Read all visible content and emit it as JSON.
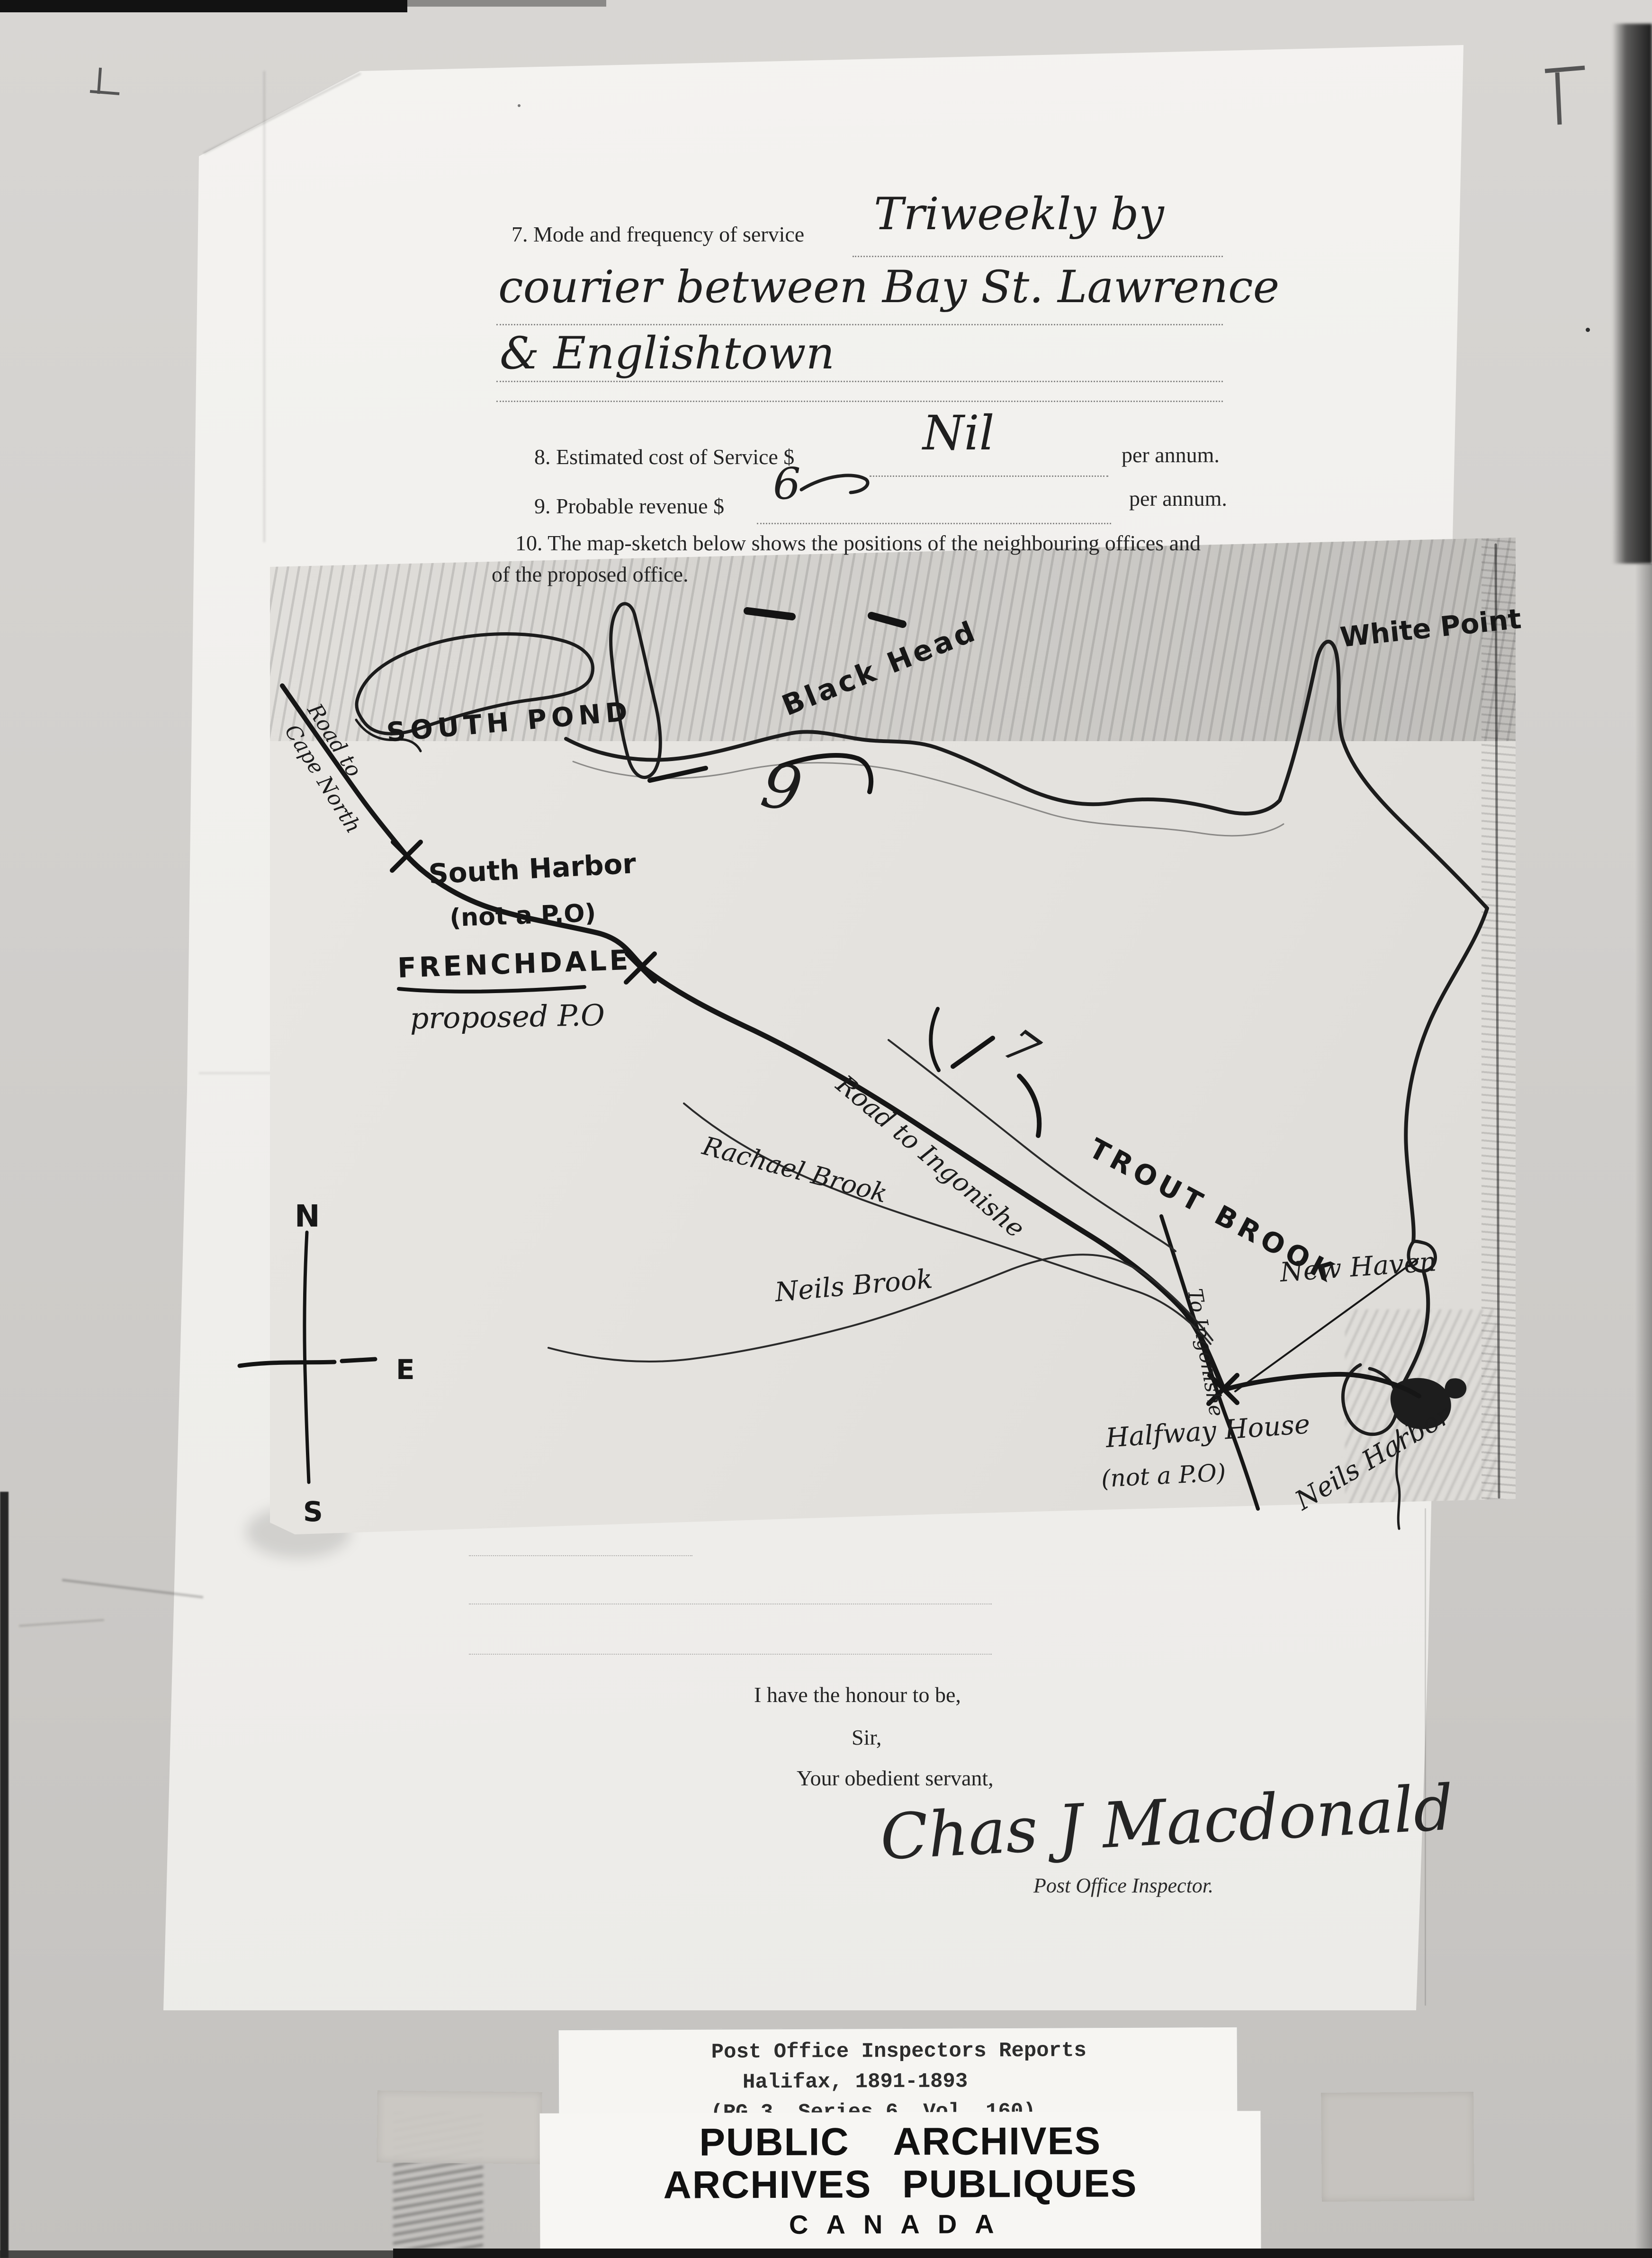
{
  "form": {
    "q7_label": "7. Mode and frequency of service",
    "q7_answer1": "Triweekly by",
    "q7_answer2": "courier between Bay St. Lawrence",
    "q7_answer3": "& Englishtown",
    "q8_label": "8. Estimated cost of Service $",
    "q8_answer": "Nil",
    "q8_per": "per annum.",
    "q9_label": "9. Probable revenue $",
    "q9_answer": "6",
    "q9_per": "per annum.",
    "q10_line1": "10. The map-sketch below shows the positions of the neighbouring offices and",
    "q10_line2": "of the proposed office."
  },
  "map": {
    "labels": {
      "south_pond": "South Pond",
      "black_head": "Black Head",
      "white_point": "White Point",
      "road_cape_north_1": "Road to",
      "road_cape_north_2": "Cape North",
      "south_harbor_1": "South Harbor",
      "south_harbor_2": "(not a P.O)",
      "frenchdale_1": "FRENCHDALE",
      "frenchdale_2": "proposed P.O",
      "road_ingonishe": "Road to Ingonishe",
      "trout_brook": "Trout Brook",
      "rachael_brook": "Rachael Brook",
      "neils_brook": "Neils Brook",
      "to_ingonishe": "To Ingonishe",
      "new_haven": "New Haven",
      "halfway_house_1": "Halfway House",
      "halfway_house_2": "(not a P.O)",
      "neils_harbor": "Neils Harbor"
    },
    "markers": {
      "mile_9": "9",
      "mile_7": "7"
    },
    "compass": {
      "north": "N",
      "east": "E",
      "south": "S"
    }
  },
  "closing": {
    "line1": "I have the honour to be,",
    "line2": "Sir,",
    "line3": "Your obedient servant,",
    "signature": "Chas J Macdonald",
    "title": "Post Office Inspector."
  },
  "archive_label": {
    "line1": "Post Office Inspectors Reports",
    "line2": "Halifax, 1891-1893",
    "line3": "(RG 3, Series 6, Vol. 160)"
  },
  "footer": {
    "line1": "PUBLIC  ARCHIVES",
    "line2": "ARCHIVES  PUBLIQUES",
    "line3": "CANADA"
  }
}
